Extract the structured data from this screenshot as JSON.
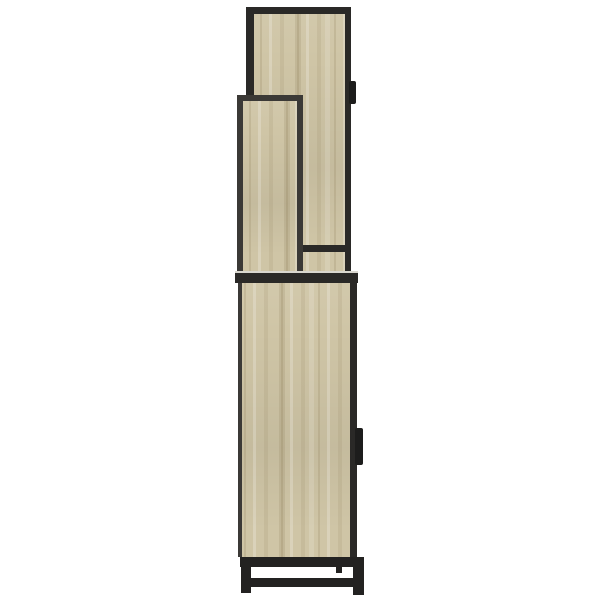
{
  "caption": "Side view of a tall sonoma oak cabinet with black metal frame: two framed wood panels on top, lower cabinet with black handle tabs, black steel base with legs and stretcher, on a plain white background",
  "colors": {
    "background": "#ffffff",
    "wood_base": "#cfc5a6",
    "wood_light": "#ded5b9",
    "wood_dark": "#b7ac8c",
    "frame_black": "#2a2927",
    "frame_edge": "#3b3936",
    "metal_black": "#232221",
    "top_surface": "#d9d7cf",
    "handle_black": "#1d1d1c"
  },
  "parts": {
    "back_panel": "tall framed side panel",
    "front_panel": "short framed side panel",
    "back_panel_handle": "black tab handle on back panel",
    "cabinet": "lower cabinet body",
    "cabinet_handle": "black tab handle on cabinet door",
    "base": "black metal base frame with legs and stretcher"
  }
}
